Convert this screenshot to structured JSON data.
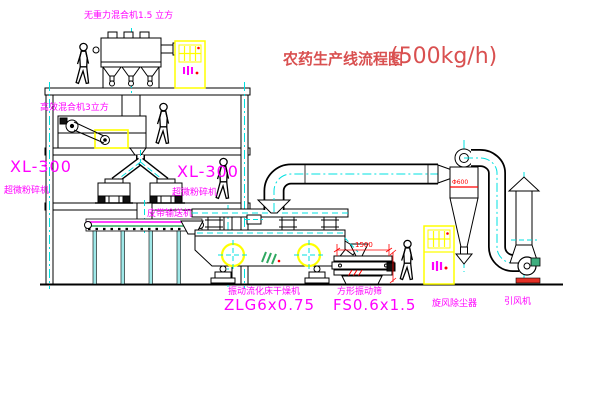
{
  "drawing": {
    "title": "农药生产线流程图",
    "capacity": "(500kg/h)"
  },
  "equipment": {
    "gravity_mixer": "无重力混合机1.5 立方",
    "high_eff_mixer": "高效混合机3立方",
    "mill_left": {
      "model": "XL-300",
      "name": "超微粉碎机"
    },
    "mill_center": {
      "model": "XL-300",
      "name": "超微粉碎机"
    },
    "belt_conveyor": "皮带输送机",
    "fluid_bed_dryer": {
      "name": "振动流化床干燥机",
      "model": "ZLG6x0.75"
    },
    "vibrating_screen": {
      "name": "方形振动筛",
      "model": "FS0.6x1.5"
    },
    "cyclone": "旋风除尘器",
    "induced_draft_fan": "引风机"
  },
  "dimensions": {
    "screen_length": "1500",
    "cyclone_note": "Φ600"
  },
  "colors": {
    "outline": "#000000",
    "centerline": "#00E0E0",
    "label_magenta": "#FF00FF",
    "title_red": "#D95050",
    "dimension_red": "#FF0000",
    "highlight_yellow": "#FFFF00",
    "logo_green": "#2FA860"
  }
}
